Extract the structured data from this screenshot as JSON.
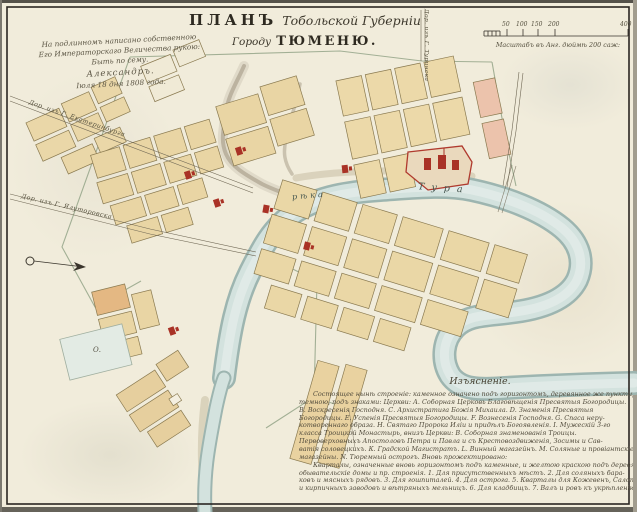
{
  "title": {
    "plan": "ПЛАНЪ",
    "province": "Тобольской Губерніи",
    "gorodu": "Городу",
    "city": "ТЮМЕНЮ."
  },
  "inscription": {
    "line1": "На подлинномъ написано собственною",
    "line2": "Его Императорскаго Величества рукою:",
    "line3": "Быть по сему.",
    "line4": "Александръ.",
    "line5": "Іюля 18 дня 1808 года."
  },
  "scale": {
    "label": "Масштабъ въ Анг. дюймѣ 200 саж:",
    "ticks": [
      "50",
      "100",
      "150",
      "200",
      "400"
    ]
  },
  "roads": {
    "ekaterinburg": "Дор. изъ Г. Екатеринбурга",
    "yalutorovsk": "Дор. изъ Г. Ялуторовска",
    "turinsk": "Дор. изъ Г. Туринска"
  },
  "river": {
    "word_reka": "рѣка",
    "word_tura": "Тура"
  },
  "pond_label": "О.",
  "legend": {
    "heading": "Изъясненіе.",
    "lines": [
      "Состоящее нынѣ строеніе: каменное означено подъ горизонтомъ, деревянное же пунктиромъ, означенное въ кварталахъ",
      "темною, подъ знаками: Церкви: А. Соборная Церковь Благовѣщенія Пресвятыя Богородицы.",
      "В. Воскресенія Господня. С. Архистратига Божія Михаила. D. Знаменія Пресвятыя",
      "Богородицы. Е. Успенія Пресвятыя Богородицы. F. Вознесенія Господня. G. Спаса неру-",
      "котвореннаго образа. Н. Святаго Пророка Иліи и придѣлъ Богоявленія. I. Мужескій 3-го",
      "класса Троицкой Монастырь, внизъ Церкви: В. Соборная знаменованія Троицы.",
      "Первоверховныхъ Апостоловъ Петра и Павла и съ Крестовоздвиженія, Зосимы и Сав-",
      "ватія соловецкихъ. К. Градской Магистратъ. L. Винный магазейнъ. М. Соляные и провіантскіе",
      "магазейны. N. Тюремный острогъ.      Вновь прожектировано:",
      "Кварталы, означенные вновь горизонтомъ подъ каменные, и желтою краскою подъ деревянные казенныя,",
      "обывательскіе домы и пр. строенія. 1. Для присутственныхъ мѣстъ. 2. Для соляныхъ бара-",
      "ковъ и мясныхъ рядовъ. 3. Для гошпиталей. 4. Для острога. 5. Кварталы для Кожевенъ, Салотопенъ, чугунныхъ",
      "и кирпичныхъ заводовъ и вѣтряныхъ мельницъ. 6. Для кладбищъ. 7. Валъ и ровъ къ укрѣпленію города."
    ]
  },
  "colors": {
    "paper": "#f1ecdb",
    "block_tan": "#e9d5a4",
    "block_pink": "#ecc3ac",
    "church_red": "#a93226",
    "river_water": "#d3e2de",
    "river_edge": "#9db5b0",
    "ink": "#3a352a",
    "boundary_green": "#8fa083"
  }
}
